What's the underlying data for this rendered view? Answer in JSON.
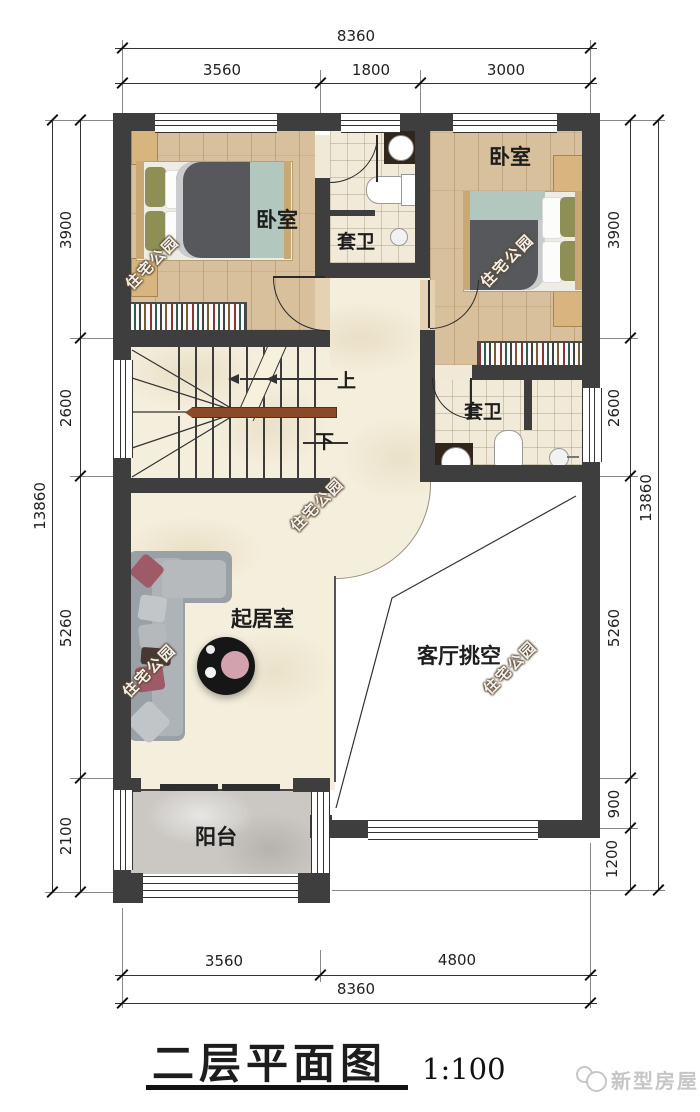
{
  "meta": {
    "title": "二层平面图",
    "scale": "1:100",
    "brand": "新型房屋",
    "watermark": "住宅公园"
  },
  "rooms": {
    "bedroom_left": "卧室",
    "bedroom_right": "卧室",
    "bath_top": "套卫",
    "bath_right": "套卫",
    "living": "起居室",
    "void": "客厅挑空",
    "balcony": "阳台"
  },
  "stairs": {
    "up": "上",
    "down": "下"
  },
  "dims": {
    "top": {
      "overall": "8360",
      "segments": [
        "3560",
        "1800",
        "3000"
      ]
    },
    "bottom": {
      "overall": "8360",
      "segments": [
        "3560",
        "4800"
      ]
    },
    "left": {
      "overall": "13860",
      "segments": [
        "3900",
        "2600",
        "5260",
        "2100"
      ]
    },
    "right": {
      "overall": "13860",
      "segments": [
        "3900",
        "2600",
        "5260",
        "900",
        "1200"
      ]
    }
  },
  "colors": {
    "wall": "#3e3e3e",
    "wood": "#d9c09c",
    "tile": "#f1ead9",
    "marble": "#f4eedc",
    "balcony_floor": "#cbc8c4",
    "handrail": "#8a4a28",
    "duvet": "#56585b",
    "mint": "#b2c8bf"
  }
}
